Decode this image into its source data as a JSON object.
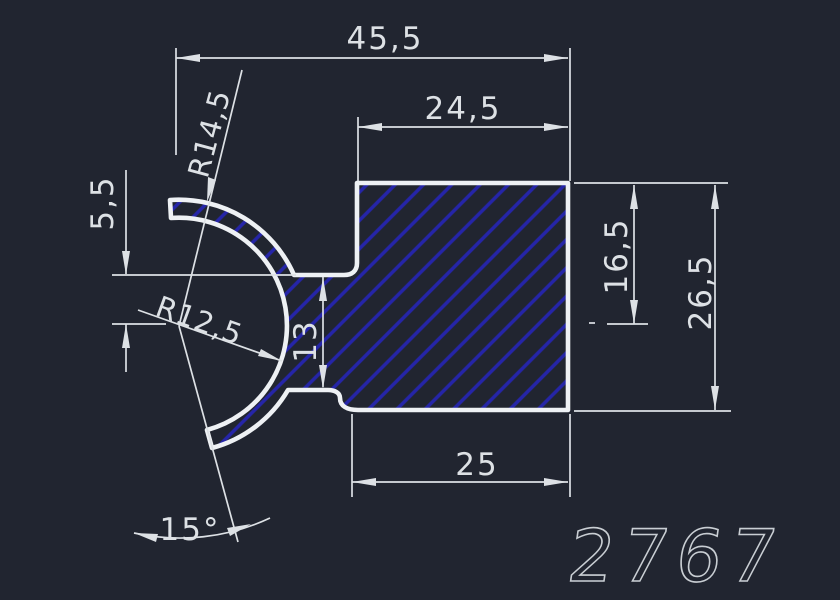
{
  "canvas": {
    "colors": {
      "background": "#212530",
      "outline": "#eef1f4",
      "hatch": "#2525a8",
      "dimension": "#dde1e5",
      "title": "#c9ced3"
    }
  },
  "drawing": {
    "number": "2767",
    "dimensions": {
      "total_width": "45,5",
      "block_width": "24,5",
      "bottom_width": "25",
      "right_height": "26,5",
      "top_to_center_height": "16,5",
      "neck_thickness": "13",
      "lip_to_center": "5,5",
      "outer_radius": "R14,5",
      "inner_radius": "R12,5",
      "opening_angle": "15°"
    }
  }
}
